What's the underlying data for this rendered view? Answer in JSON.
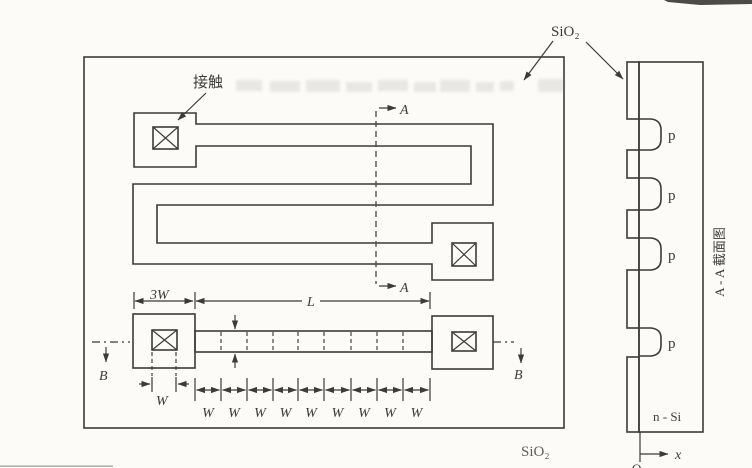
{
  "figure": {
    "kind": "semiconductor diffused resistor layout and cross-section (scanned textbook figure)"
  },
  "topview": {
    "contact_label": "接触",
    "sio2_top_label": "SiO₂",
    "sio2_bottom_label": "SiO₂",
    "section_a_label": "A",
    "section_b_label": "B",
    "dim_3w_label": "3W",
    "dim_L_label": "L",
    "dim_W_label": "W",
    "w_chain": [
      "W",
      "W",
      "W",
      "W",
      "W",
      "W",
      "W",
      "W",
      "W"
    ]
  },
  "cross_section": {
    "title_rotated": "A - A 截面图",
    "p_labels": [
      "p",
      "p",
      "p",
      "p"
    ],
    "substrate_label": "n - Si",
    "x_axis_label": "x",
    "origin_label": "O"
  },
  "colors": {
    "line": "#3b3b3a",
    "paper": "#fcfbf8",
    "oxide_field": "#efece5",
    "resistor_fill": "#fbfaf6",
    "stipple_dot": "#b4ada0"
  }
}
